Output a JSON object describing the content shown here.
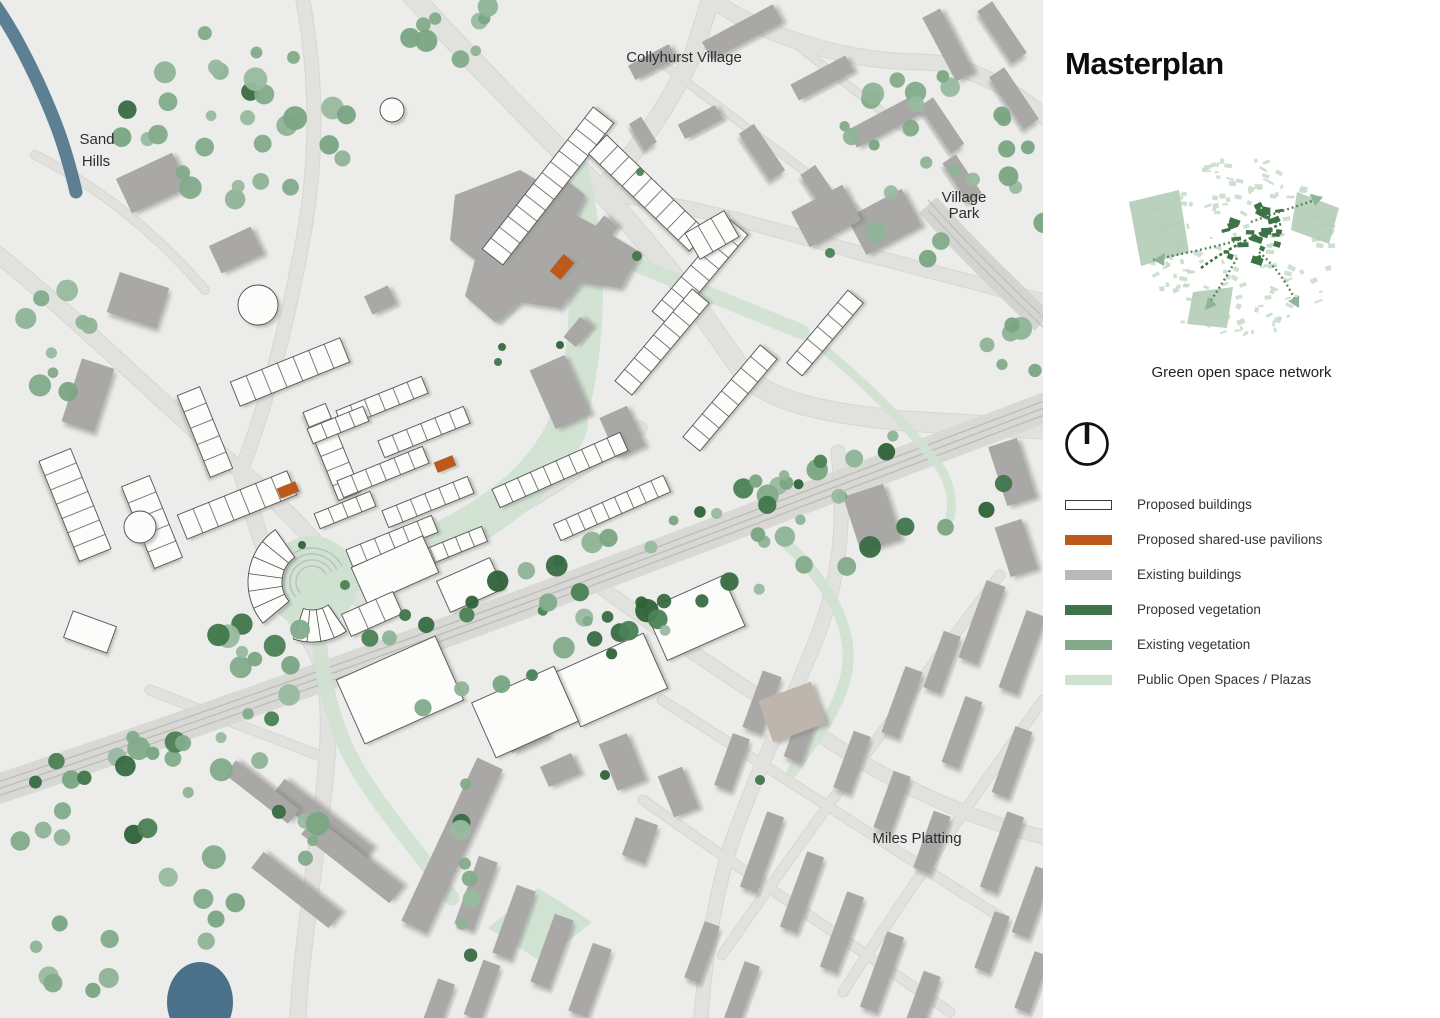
{
  "panel": {
    "title": "Masterplan",
    "inset_caption": "Green open space network"
  },
  "map_labels": {
    "collyhurst": "Collyhurst Village",
    "sand_hills_line1": "Sand",
    "sand_hills_line2": "Hills",
    "village_park_line1": "Village",
    "village_park_line2": "Park",
    "miles_platting": "Miles Platting"
  },
  "legend": {
    "items": [
      {
        "label": "Proposed buildings",
        "color": "#ffffff",
        "border": "#3c3c3c"
      },
      {
        "label": "Proposed shared-use pavilions",
        "color": "#bc5a1b",
        "border": "none"
      },
      {
        "label": "Existing buildings",
        "color": "#b9b9bd",
        "border": "none"
      },
      {
        "label": "Proposed vegetation",
        "color": "#3d7346",
        "border": "none"
      },
      {
        "label": "Existing vegetation",
        "color": "#83ab8b",
        "border": "none"
      },
      {
        "label": "Public Open Spaces / Plazas",
        "color": "#cde3d0",
        "border": "none"
      }
    ]
  },
  "map_colors": {
    "background": "#ecedea",
    "road": "#e1e2de",
    "railway": "#d8d9d5",
    "railway_track": "#bdbeba",
    "water": "#4e7289",
    "open_space": "#cfe2d1",
    "proposed_building": "#fcfcfb",
    "existing_building": "#a9a8a6",
    "proposed_vegetation": "#3d7346",
    "existing_vegetation": "#8bb193",
    "pavilion": "#bc5a1b"
  }
}
